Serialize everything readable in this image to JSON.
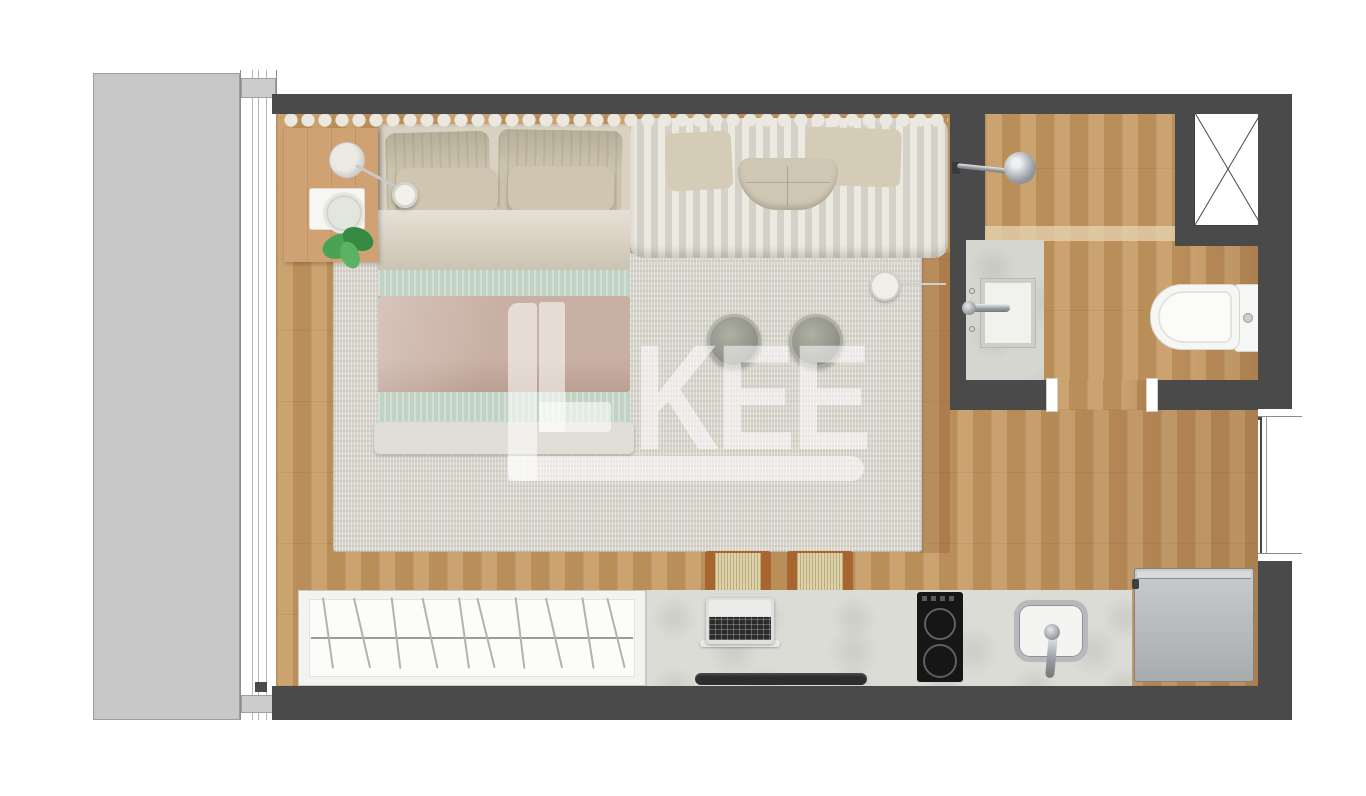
{
  "watermark": {
    "text": "LKEE",
    "initial": "L",
    "letters": "KEE"
  },
  "palette": {
    "wall": "#4a4a4b",
    "wood_floor": "#c1965f",
    "balcony": "#c7c7c7",
    "rug": "#d8d5cc",
    "counter_concrete": "#dcdcd7",
    "sofa_ribbed": "#e0ddd5",
    "blanket_pink": "#c9b0a4",
    "blanket_mint": "#c2d3c5",
    "plant_green": "#4aa355",
    "fixture_white": "#f6f6f4",
    "steel_fridge": "#b9bcbe",
    "cooktop_black": "#161616",
    "chrome": "#9aa0a5"
  },
  "rooms": [
    {
      "name": "balcony"
    },
    {
      "name": "main-living-bedroom"
    },
    {
      "name": "bathroom"
    },
    {
      "name": "kitchen-strip"
    }
  ],
  "fixtures": [
    "sliding-window-track",
    "curtain",
    "double-bed",
    "pillows",
    "nightstand",
    "table-lamp",
    "reading-lamp",
    "decorative-tray",
    "monstera-plant",
    "ribbed-daybed-sofa",
    "side-table",
    "pouf",
    "pouf",
    "fringe-stool",
    "fringe-stool",
    "wardrobe-with-hangers",
    "desk-counter",
    "laptop",
    "bench-rail",
    "two-burner-cooktop",
    "kitchen-sink",
    "refrigerator",
    "shower-head",
    "vanity-sink",
    "toilet",
    "duct-shaft-x",
    "right-window",
    "bathroom-door-opening"
  ]
}
